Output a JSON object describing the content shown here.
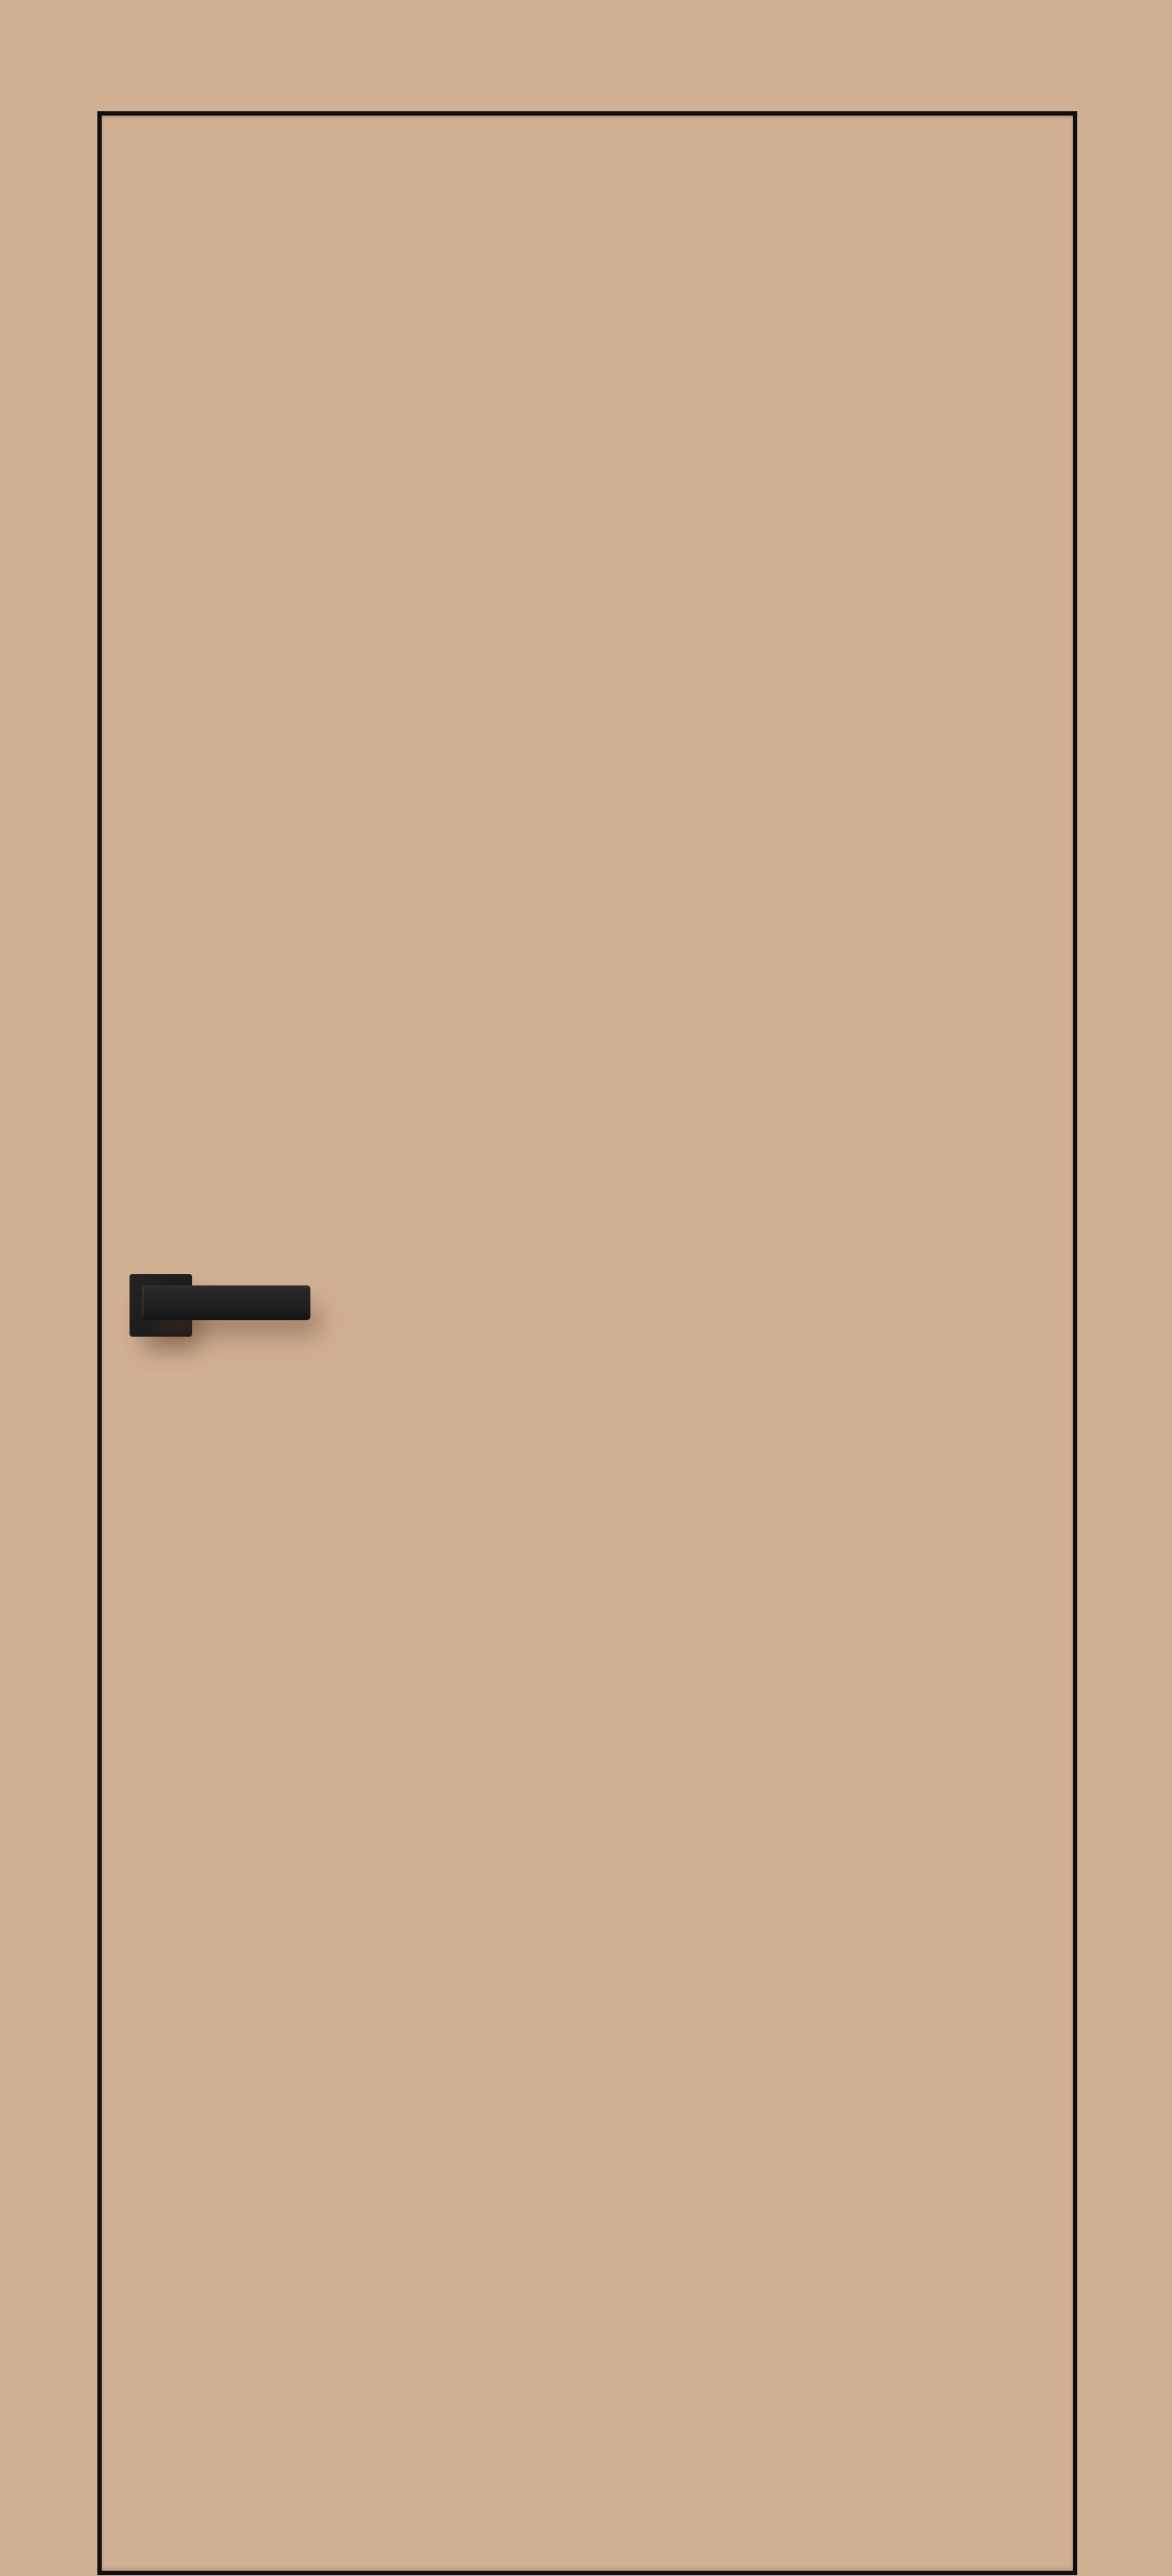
{
  "scene": {
    "description": "Front view of a closed flush interior door, beige finish matching the wall, thin black edge trim, black square-rosette lever handle on the left side",
    "door": {
      "style": "flush frameless leaf",
      "edge_trim": "thin dark outline"
    },
    "handle": {
      "type": "lever on square rosette",
      "finish": "matte black",
      "side": "left",
      "lever_direction": "pointing right"
    }
  },
  "colors": {
    "background_color": "#d1af93",
    "door_face_color": "#d1af93",
    "door_edge_color": "#0f0f0f",
    "rosette_color": "#1d1d1d",
    "rosette_color_light": "#242424",
    "lever_color": "#262626",
    "shadow_color": "rgba(88,58,38,0.42)"
  }
}
